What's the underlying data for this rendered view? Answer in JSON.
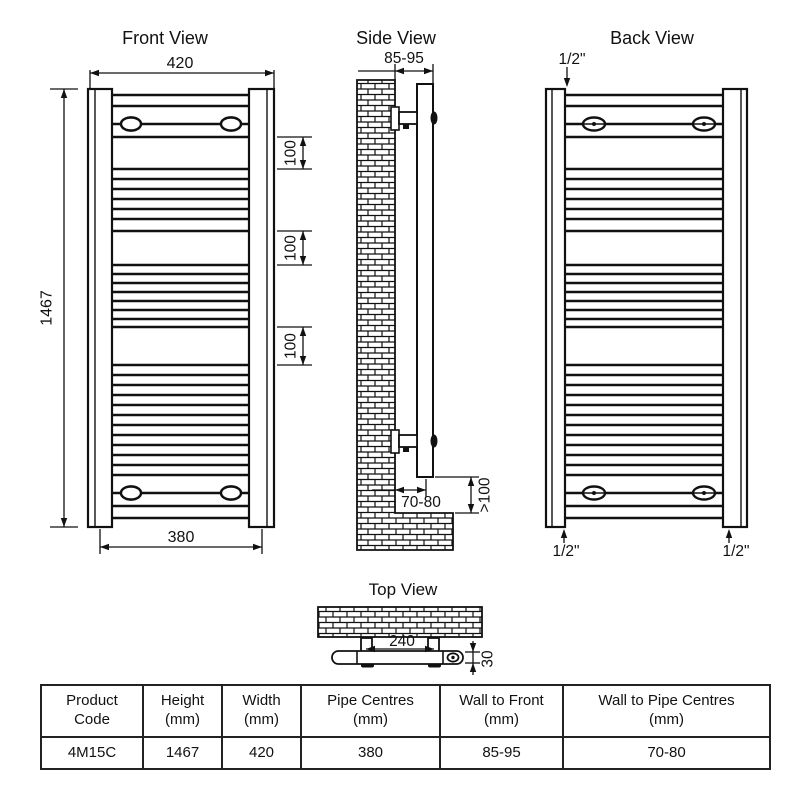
{
  "views": {
    "front": {
      "title": "Front View",
      "width": "420",
      "height": "1467",
      "pipe_centres": "380",
      "rung_gaps": [
        "100",
        "100",
        "100"
      ]
    },
    "side": {
      "title": "Side View",
      "wall_to_front": "85-95",
      "wall_to_pipe_centres": "70-80",
      "floor_clearance": ">100"
    },
    "back": {
      "title": "Back View",
      "connection_top": "1/2\"",
      "connection_bottom_left": "1/2\"",
      "connection_bottom_right": "1/2\""
    },
    "top": {
      "title": "Top View",
      "bracket_centres": "240",
      "depth": "30"
    }
  },
  "table": {
    "headers": [
      {
        "l1": "Product",
        "l2": "Code"
      },
      {
        "l1": "Height",
        "l2": "(mm)"
      },
      {
        "l1": "Width",
        "l2": "(mm)"
      },
      {
        "l1": "Pipe Centres",
        "l2": "(mm)"
      },
      {
        "l1": "Wall to Front",
        "l2": "(mm)"
      },
      {
        "l1": "Wall to Pipe Centres",
        "l2": "(mm)"
      }
    ],
    "row": [
      "4M15C",
      "1467",
      "420",
      "380",
      "85-95",
      "70-80"
    ]
  },
  "colors": {
    "line": "#111111",
    "background": "#ffffff"
  }
}
